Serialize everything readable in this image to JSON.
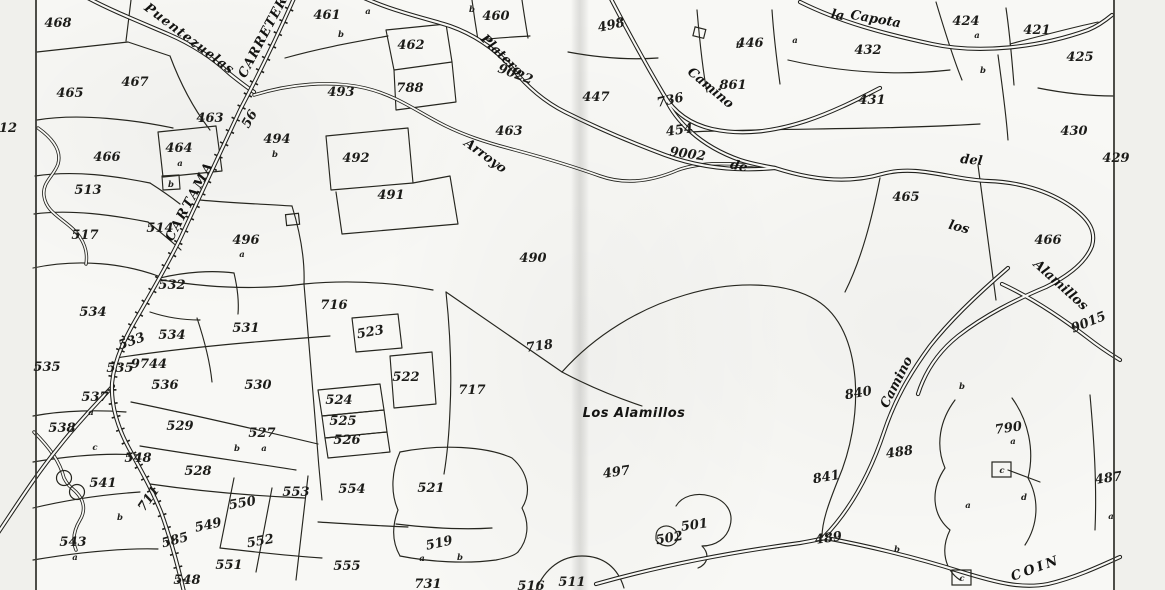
{
  "map": {
    "colors": {
      "ink": "#1c1c19",
      "paper": "#f8f8f5"
    },
    "parcel_labels": [
      {
        "t": "468",
        "x": 58,
        "y": 27
      },
      {
        "t": "465",
        "x": 70,
        "y": 97
      },
      {
        "t": "467",
        "x": 135,
        "y": 86
      },
      {
        "t": "463",
        "x": 210,
        "y": 122
      },
      {
        "t": "466",
        "x": 107,
        "y": 161
      },
      {
        "t": "464",
        "x": 179,
        "y": 152,
        "s": 11.5
      },
      {
        "t": "513",
        "x": 88,
        "y": 194
      },
      {
        "t": "517",
        "x": 85,
        "y": 239
      },
      {
        "t": "514",
        "x": 160,
        "y": 232,
        "s": 12
      },
      {
        "t": "12",
        "x": 8,
        "y": 132,
        "s": 12
      },
      {
        "t": "532",
        "x": 172,
        "y": 289
      },
      {
        "t": "534",
        "x": 93,
        "y": 316
      },
      {
        "t": "534",
        "x": 172,
        "y": 339
      },
      {
        "t": "533",
        "x": 133,
        "y": 345,
        "r": -20
      },
      {
        "t": "535",
        "x": 47,
        "y": 371
      },
      {
        "t": "535",
        "x": 120,
        "y": 372,
        "s": 11
      },
      {
        "t": "9744",
        "x": 149,
        "y": 368,
        "s": 8.5
      },
      {
        "t": "536",
        "x": 165,
        "y": 389
      },
      {
        "t": "537",
        "x": 95,
        "y": 401
      },
      {
        "t": "538",
        "x": 62,
        "y": 432,
        "s": 11.5
      },
      {
        "t": "529",
        "x": 180,
        "y": 430
      },
      {
        "t": "527",
        "x": 262,
        "y": 437
      },
      {
        "t": "528",
        "x": 198,
        "y": 475
      },
      {
        "t": "541",
        "x": 103,
        "y": 487
      },
      {
        "t": "548",
        "x": 138,
        "y": 462,
        "s": 11
      },
      {
        "t": "711",
        "x": 152,
        "y": 501,
        "s": 11,
        "r": -55
      },
      {
        "t": "543",
        "x": 73,
        "y": 546
      },
      {
        "t": "585",
        "x": 176,
        "y": 544,
        "s": 11,
        "r": -15
      },
      {
        "t": "549",
        "x": 209,
        "y": 529,
        "r": -12
      },
      {
        "t": "550",
        "x": 243,
        "y": 507,
        "r": -10
      },
      {
        "t": "551",
        "x": 229,
        "y": 569
      },
      {
        "t": "552",
        "x": 261,
        "y": 545,
        "r": -10
      },
      {
        "t": "553",
        "x": 296,
        "y": 496
      },
      {
        "t": "554",
        "x": 352,
        "y": 493
      },
      {
        "t": "555",
        "x": 347,
        "y": 570
      },
      {
        "t": "548",
        "x": 187,
        "y": 584,
        "s": 11
      },
      {
        "t": "531",
        "x": 246,
        "y": 332
      },
      {
        "t": "530",
        "x": 258,
        "y": 389
      },
      {
        "t": "716",
        "x": 334,
        "y": 309
      },
      {
        "t": "523",
        "x": 371,
        "y": 336,
        "r": -10
      },
      {
        "t": "522",
        "x": 406,
        "y": 381
      },
      {
        "t": "524",
        "x": 339,
        "y": 404,
        "s": 11.5
      },
      {
        "t": "525",
        "x": 343,
        "y": 425,
        "s": 11.5
      },
      {
        "t": "526",
        "x": 347,
        "y": 444,
        "s": 11.5
      },
      {
        "t": "521",
        "x": 431,
        "y": 492
      },
      {
        "t": "519",
        "x": 440,
        "y": 547,
        "s": 11.5,
        "r": -12
      },
      {
        "t": "717",
        "x": 472,
        "y": 394
      },
      {
        "t": "718",
        "x": 540,
        "y": 350,
        "r": -8
      },
      {
        "t": "731",
        "x": 428,
        "y": 588,
        "s": 11
      },
      {
        "t": "516",
        "x": 531,
        "y": 590,
        "s": 11
      },
      {
        "t": "511",
        "x": 572,
        "y": 586
      },
      {
        "t": "493",
        "x": 341,
        "y": 96
      },
      {
        "t": "788",
        "x": 410,
        "y": 92,
        "s": 11
      },
      {
        "t": "492",
        "x": 356,
        "y": 162
      },
      {
        "t": "491",
        "x": 391,
        "y": 199
      },
      {
        "t": "496",
        "x": 246,
        "y": 244
      },
      {
        "t": "494",
        "x": 277,
        "y": 143,
        "s": 11.5
      },
      {
        "t": "461",
        "x": 327,
        "y": 19
      },
      {
        "t": "462",
        "x": 411,
        "y": 49
      },
      {
        "t": "460",
        "x": 496,
        "y": 20
      },
      {
        "t": "463",
        "x": 509,
        "y": 135
      },
      {
        "t": "490",
        "x": 533,
        "y": 262
      },
      {
        "t": "498",
        "x": 612,
        "y": 29,
        "s": 11,
        "r": -12
      },
      {
        "t": "447",
        "x": 596,
        "y": 101
      },
      {
        "t": "446",
        "x": 750,
        "y": 47
      },
      {
        "t": "736",
        "x": 671,
        "y": 104,
        "r": -12
      },
      {
        "t": "861",
        "x": 733,
        "y": 89,
        "s": 11.5
      },
      {
        "t": "454",
        "x": 680,
        "y": 134,
        "s": 10.5,
        "r": -8
      },
      {
        "t": "9022",
        "x": 514,
        "y": 78,
        "s": 10,
        "r": 20
      },
      {
        "t": "9002",
        "x": 687,
        "y": 158,
        "s": 10,
        "r": 8
      },
      {
        "t": "432",
        "x": 868,
        "y": 54
      },
      {
        "t": "431",
        "x": 872,
        "y": 104
      },
      {
        "t": "424",
        "x": 966,
        "y": 25
      },
      {
        "t": "421",
        "x": 1037,
        "y": 34,
        "s": 12
      },
      {
        "t": "425",
        "x": 1080,
        "y": 61
      },
      {
        "t": "430",
        "x": 1074,
        "y": 135
      },
      {
        "t": "429",
        "x": 1116,
        "y": 162,
        "s": 11
      },
      {
        "t": "465",
        "x": 906,
        "y": 201
      },
      {
        "t": "466",
        "x": 1048,
        "y": 244
      },
      {
        "t": "497",
        "x": 617,
        "y": 476,
        "r": -8
      },
      {
        "t": "501",
        "x": 695,
        "y": 529,
        "r": -8
      },
      {
        "t": "502",
        "x": 670,
        "y": 542,
        "s": 11,
        "r": -10
      },
      {
        "t": "840",
        "x": 859,
        "y": 397,
        "r": -10
      },
      {
        "t": "841",
        "x": 827,
        "y": 481,
        "r": -10
      },
      {
        "t": "489",
        "x": 829,
        "y": 542,
        "r": -8
      },
      {
        "t": "488",
        "x": 900,
        "y": 456,
        "r": -8
      },
      {
        "t": "487",
        "x": 1109,
        "y": 482,
        "r": -8
      },
      {
        "t": "790",
        "x": 1009,
        "y": 432,
        "s": 10.5,
        "r": -8
      },
      {
        "t": "9015",
        "x": 1090,
        "y": 326,
        "s": 10,
        "r": -22
      },
      {
        "t": "56",
        "x": 253,
        "y": 121,
        "s": 9,
        "r": -60
      }
    ],
    "place_labels": [
      {
        "t": "Puentezuelas",
        "x": 187,
        "y": 42,
        "r": 37,
        "s": 13,
        "ls": 1
      },
      {
        "t": "CARRETERA",
        "x": 269,
        "y": 34,
        "r": -62,
        "s": 13,
        "ls": 1
      },
      {
        "t": "CARTAMA",
        "x": 193,
        "y": 203,
        "r": -62,
        "s": 13.5,
        "ls": 2
      },
      {
        "t": "Arroyo",
        "x": 483,
        "y": 159,
        "r": 36,
        "s": 14
      },
      {
        "t": "de",
        "x": 738,
        "y": 170,
        "r": 12,
        "s": 12.5
      },
      {
        "t": "los",
        "x": 958,
        "y": 231,
        "r": 14,
        "s": 12.5
      },
      {
        "t": "Alamillos",
        "x": 1058,
        "y": 288,
        "r": 42,
        "s": 12.5
      },
      {
        "t": "del",
        "x": 971,
        "y": 164,
        "r": 6,
        "s": 10
      },
      {
        "t": "Platero",
        "x": 499,
        "y": 58,
        "r": 44,
        "s": 11.5
      },
      {
        "t": "Camino",
        "x": 708,
        "y": 91,
        "r": 40,
        "s": 11
      },
      {
        "t": "Camino",
        "x": 900,
        "y": 384,
        "r": -63,
        "s": 11
      },
      {
        "t": "la",
        "x": 837,
        "y": 19,
        "r": 10,
        "s": 9
      },
      {
        "t": "Capota",
        "x": 875,
        "y": 23,
        "r": 10,
        "s": 12.5
      },
      {
        "t": "Los Alamillos",
        "x": 634,
        "y": 417,
        "s": 16.5,
        "f": "sans",
        "ls": 0.5
      },
      {
        "t": "COIN",
        "x": 1037,
        "y": 572,
        "r": -20,
        "s": 13,
        "ls": 3
      }
    ],
    "markers": [
      {
        "t": "a",
        "x": 368,
        "y": 14
      },
      {
        "t": "a",
        "x": 795,
        "y": 43
      },
      {
        "t": "a",
        "x": 977,
        "y": 38
      },
      {
        "t": "a",
        "x": 180,
        "y": 166
      },
      {
        "t": "a",
        "x": 242,
        "y": 257
      },
      {
        "t": "a",
        "x": 264,
        "y": 451
      },
      {
        "t": "a",
        "x": 422,
        "y": 561
      },
      {
        "t": "a",
        "x": 1013,
        "y": 444
      },
      {
        "t": "a",
        "x": 968,
        "y": 508
      },
      {
        "t": "a",
        "x": 91,
        "y": 415
      },
      {
        "t": "a",
        "x": 75,
        "y": 560
      },
      {
        "t": "a",
        "x": 1111,
        "y": 519
      },
      {
        "t": "b",
        "x": 341,
        "y": 37
      },
      {
        "t": "b",
        "x": 472,
        "y": 12
      },
      {
        "t": "b",
        "x": 983,
        "y": 73
      },
      {
        "t": "b",
        "x": 739,
        "y": 48
      },
      {
        "t": "b",
        "x": 275,
        "y": 157
      },
      {
        "t": "b",
        "x": 237,
        "y": 451
      },
      {
        "t": "b",
        "x": 460,
        "y": 560
      },
      {
        "t": "b",
        "x": 120,
        "y": 520
      },
      {
        "t": "b",
        "x": 897,
        "y": 552
      },
      {
        "t": "b",
        "x": 962,
        "y": 389
      },
      {
        "t": "b",
        "x": 171,
        "y": 187
      },
      {
        "t": "c",
        "x": 95,
        "y": 450
      },
      {
        "t": "c",
        "x": 1002,
        "y": 473
      },
      {
        "t": "c",
        "x": 962,
        "y": 581
      },
      {
        "t": "d",
        "x": 1024,
        "y": 500
      }
    ]
  }
}
